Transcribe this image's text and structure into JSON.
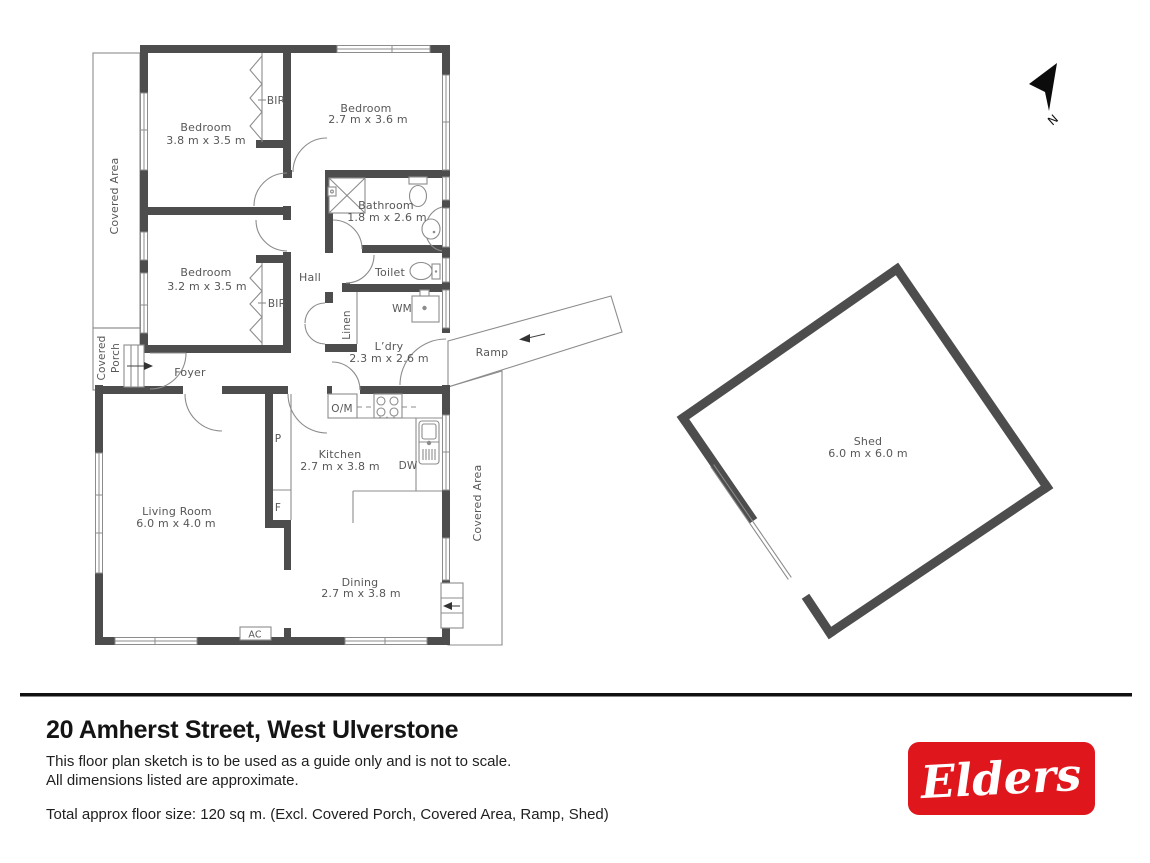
{
  "footer": {
    "address": "20 Amherst Street, West Ulverstone",
    "disclaimer1": "This floor plan sketch is to be used as a guide only and is not to scale.",
    "disclaimer2": "All dimensions listed are approximate.",
    "total": "Total approx floor size: 120 sq m. (Excl. Covered Porch, Covered Area, Ramp, Shed)",
    "brand": "Elders"
  },
  "compass": {
    "north": "N"
  },
  "colors": {
    "wall": "#4d4d4d",
    "line": "#8c8c8c",
    "label": "#575757",
    "brand_red": "#e0161d",
    "ink": "#141414"
  },
  "rooms": {
    "bedroom1": {
      "name": "Bedroom",
      "dims": "3.8 m x 3.5 m"
    },
    "bedroom2": {
      "name": "Bedroom",
      "dims": "2.7 m x 3.6 m"
    },
    "bedroom3": {
      "name": "Bedroom",
      "dims": "3.2 m x 3.5 m"
    },
    "bathroom": {
      "name": "Bathroom",
      "dims": "1.8 m x 2.6 m"
    },
    "laundry": {
      "name": "L’dry",
      "dims": "2.3 m x 2.6 m"
    },
    "kitchen": {
      "name": "Kitchen",
      "dims": "2.7 m x 3.8 m"
    },
    "living": {
      "name": "Living Room",
      "dims": "6.0 m x 4.0 m"
    },
    "dining": {
      "name": "Dining",
      "dims": "2.7 m x 3.8 m"
    },
    "shed": {
      "name": "Shed",
      "dims": "6.0 m x 6.0 m"
    },
    "hall": "Hall",
    "foyer": "Foyer",
    "toilet": "Toilet",
    "linen": "Linen",
    "bir1": "BIR",
    "bir2": "BIR",
    "wm": "WM",
    "om": "O/M",
    "dw": "DW",
    "pantry": "P",
    "fridge": "F",
    "ac": "AC",
    "ramp": "Ramp",
    "covered_area": "Covered Area",
    "covered_porch_line1": "Covered",
    "covered_porch_line2": "Porch"
  }
}
